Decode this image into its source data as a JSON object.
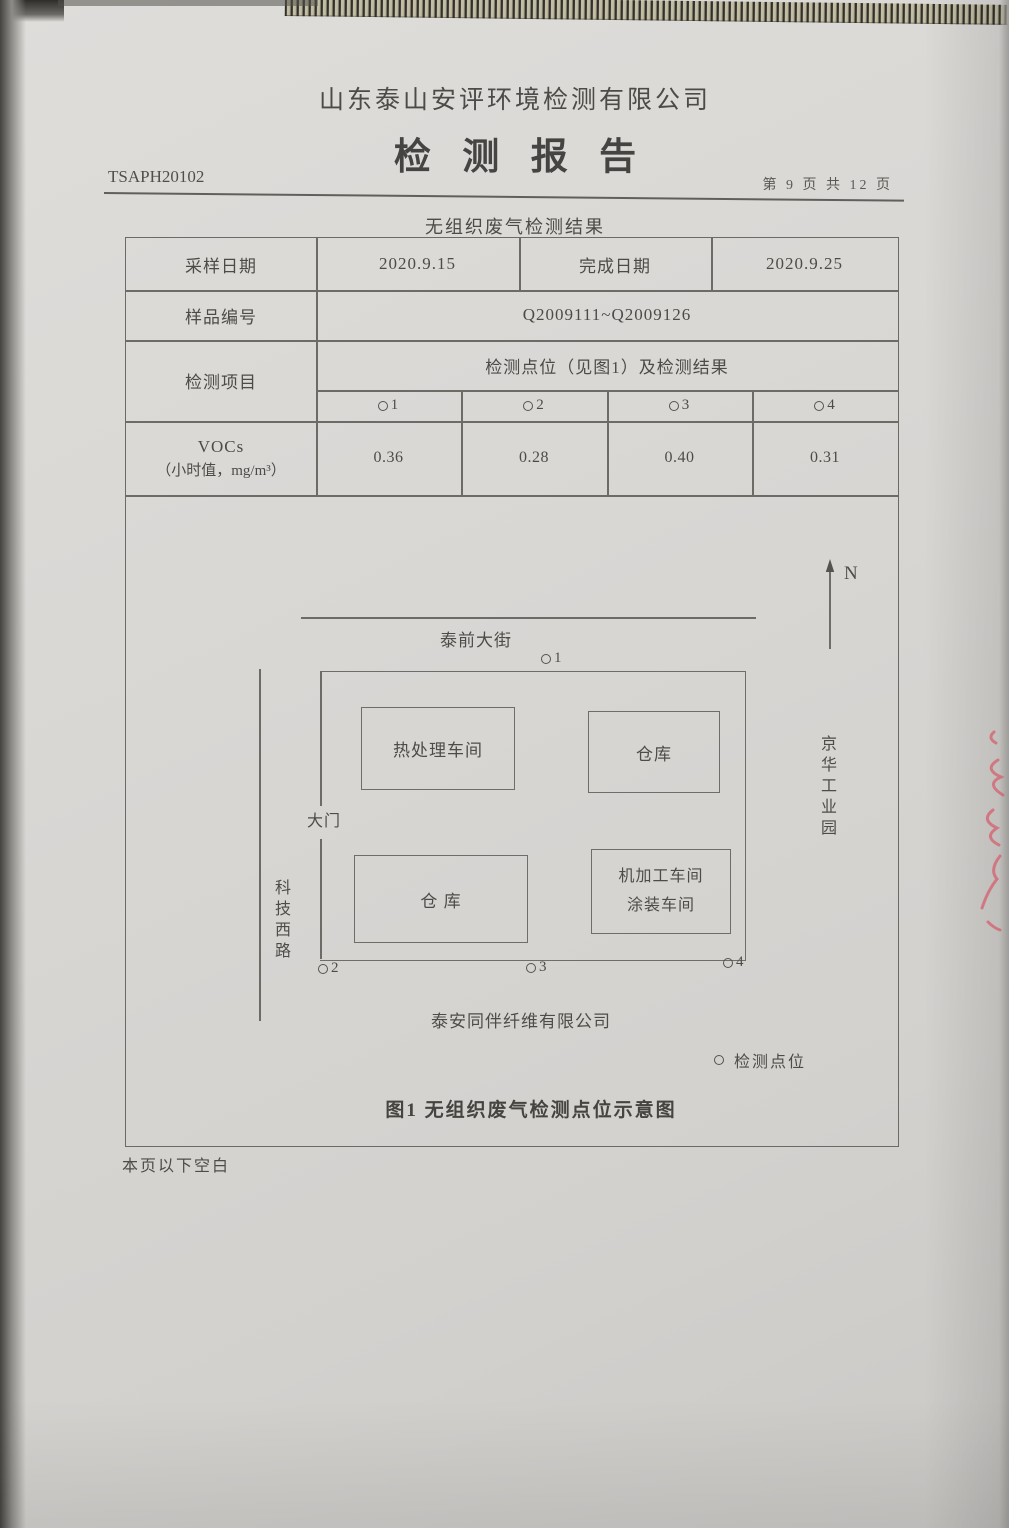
{
  "colors": {
    "paper": "#d8d6d3",
    "ink": "#4d4b47",
    "line": "#6d6b66",
    "red_mark": "#d4606e"
  },
  "header": {
    "company": "山东泰山安评环境检测有限公司",
    "report_title": "检测报告",
    "report_no": "TSAPH20102",
    "page_indicator": "第 9 页 共 12 页"
  },
  "section": {
    "title": "无组织废气检测结果"
  },
  "table": {
    "sampling_date_label": "采样日期",
    "sampling_date": "2020.9.15",
    "completion_date_label": "完成日期",
    "completion_date": "2020.9.25",
    "sample_no_label": "样品编号",
    "sample_no": "Q2009111~Q2009126",
    "item_label": "检测项目",
    "points_header": "检测点位（见图1）及检测结果",
    "point_ids": [
      "1",
      "2",
      "3",
      "4"
    ],
    "voc_name": "VOCs",
    "voc_unit": "（小时值，mg/m³）",
    "voc_values": [
      "0.36",
      "0.28",
      "0.40",
      "0.31"
    ]
  },
  "diagram": {
    "north_label": "N",
    "street_top": "泰前大街",
    "road_left": "科技西路",
    "park_right": "京华工业园",
    "gate_label": "大门",
    "building_heat_treatment": "热处理车间",
    "building_warehouse_top": "仓库",
    "building_warehouse_bottom": "仓  库",
    "building_machining_line1": "机加工车间",
    "building_machining_line2": "涂装车间",
    "factory_name": "泰安同伴纤维有限公司",
    "points": [
      "1",
      "2",
      "3",
      "4"
    ],
    "legend_label": "检测点位",
    "caption": "图1  无组织废气检测点位示意图"
  },
  "footer": {
    "note": "本页以下空白"
  }
}
